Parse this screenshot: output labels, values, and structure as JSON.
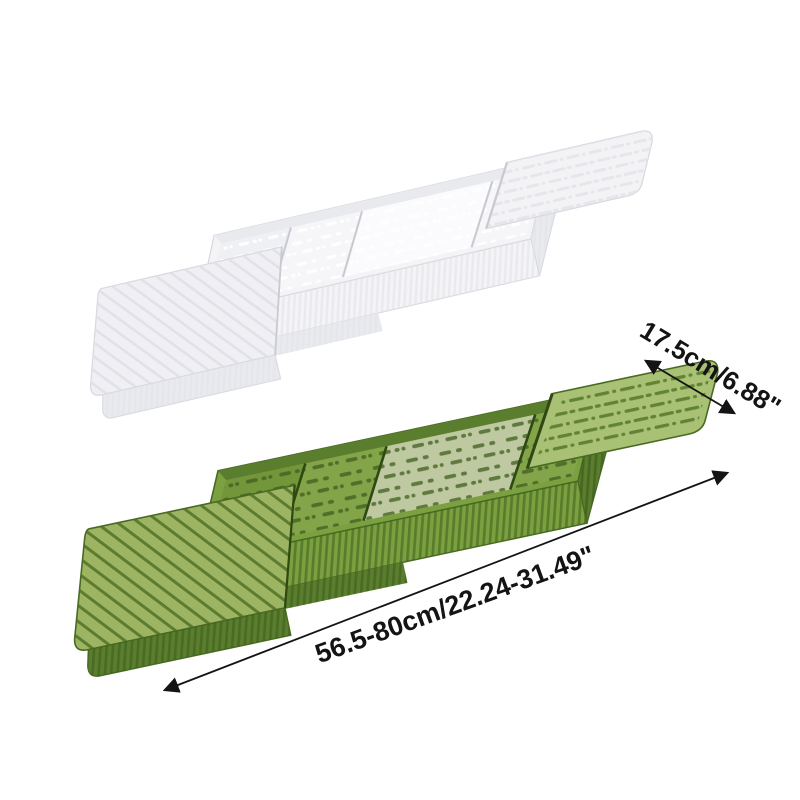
{
  "annotations": {
    "width_label": "17.5cm/6.88\"",
    "length_label": "56.5-80cm/22.24-31.49\""
  },
  "icons": {
    "width_arrow": "double-headed-arrow-icon",
    "length_arrow": "double-headed-arrow-icon"
  },
  "objects": {
    "top_tray": "white translucent extendable bathtub tray",
    "bottom_tray": "green translucent extendable bathtub tray"
  },
  "colors": {
    "background": "#ffffff",
    "annotation": "#141414",
    "green_tray": {
      "arm": "#a9c175",
      "arm_alt": "#9db562",
      "ridge": "#4d6e24",
      "vent": "#567829",
      "wall": "#7ba03f",
      "wall_dark": "#5b7e2e",
      "floor": "#84a449",
      "floor_dark": "#74963b",
      "inner": "#bec9a1",
      "perf": "#3f5e1e",
      "rib": "#3e5e1d",
      "edge": "#496a23",
      "edge_dark": "#2e4911"
    },
    "white_tray": {
      "arm": "#f3f3f6",
      "arm_alt": "#f0f0f4",
      "ridge": "#dfe0e6",
      "vent": "#e3e4e9",
      "wall": "#f4f4f7",
      "wall_dark": "#e9eaee",
      "floor": "#f6f6f9",
      "floor_dark": "#eff0f3",
      "inner": "#fbfbfd",
      "perf": "#ffffff",
      "rib": "#e1e2e7",
      "edge": "#d8d9de",
      "edge_dark": "#c9cad1"
    }
  }
}
